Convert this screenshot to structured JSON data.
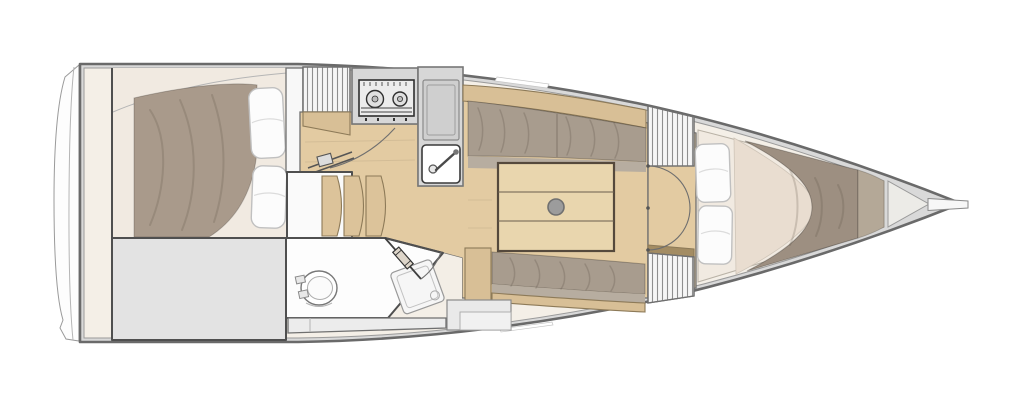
{
  "image": {
    "kind": "floor-plan",
    "subject": "sailboat-interior-top-view"
  },
  "regions": {
    "aft_cabin": "aft-cabin-double-berth",
    "aft_storage": "aft-storage-locker",
    "companionway": "companionway-steps",
    "galley": "galley-stove-and-sink",
    "salon": "salon-settees-and-table",
    "head": "head-toilet-and-shower",
    "forward_cabin": "v-berth-forward-cabin",
    "bow": "bow-with-bowsprit"
  },
  "colors": {
    "hull_stroke": "#6a6a6a",
    "deck_fill": "#d9d9d9",
    "interior_fill": "#f4efe7",
    "cabin_floor": "#f1eae1",
    "wood_floor": "#e3cba2",
    "wood_mid": "#d8bf96",
    "wood_dark": "#a38c63",
    "table_wood": "#e9d6ae",
    "step_wood": "#dcc39a",
    "cushion": "#a89c8e",
    "cushion_front": "#b7ada0",
    "blanket_aft": "#a99a8b",
    "blanket_fwd": "#9d8f81",
    "blanket_fwd_light": "#b4a897",
    "sheet": "#e9ddd0",
    "pillow": "#fcfcfc",
    "gray_area": "#e3e3e3",
    "room_white": "#fdfdfd",
    "bench": "#ececec",
    "appliance": "#d7d7d7",
    "stove_face": "#ececec",
    "cabinet": "#cfcfcf",
    "sink_white": "#ffffff",
    "knob": "#9c9c9c",
    "bow_wedge": "#ecebe7",
    "hatch_bg": "#f6f6f6",
    "transom": "#fdfdfd",
    "wedge_cream": "#f3eee6",
    "step_box": "#e9e9e9"
  }
}
